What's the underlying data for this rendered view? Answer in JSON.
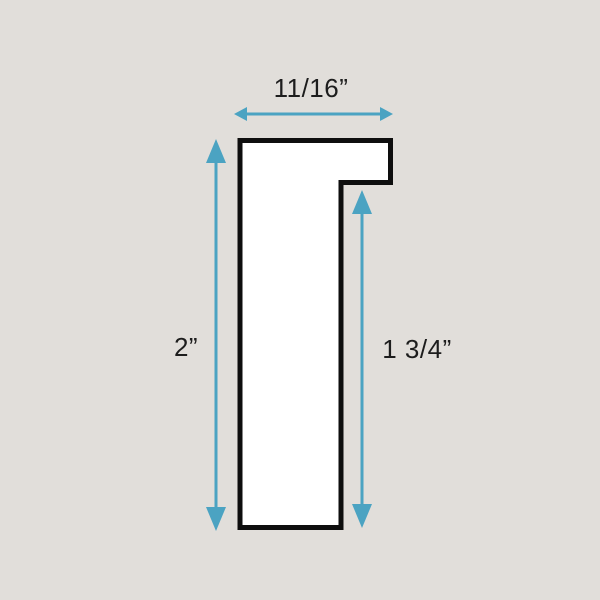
{
  "diagram": {
    "type": "moulding-profile-cross-section",
    "dimensions": {
      "top_width": "11/16”",
      "left_height": "2”",
      "right_height": "1 3/4”"
    },
    "colors": {
      "background": "#E1DEDA",
      "arrow": "#4BA3C2",
      "outline": "#0E0E0E",
      "shape_fill": "#FFFFFF",
      "text": "#1D1D1D"
    }
  }
}
